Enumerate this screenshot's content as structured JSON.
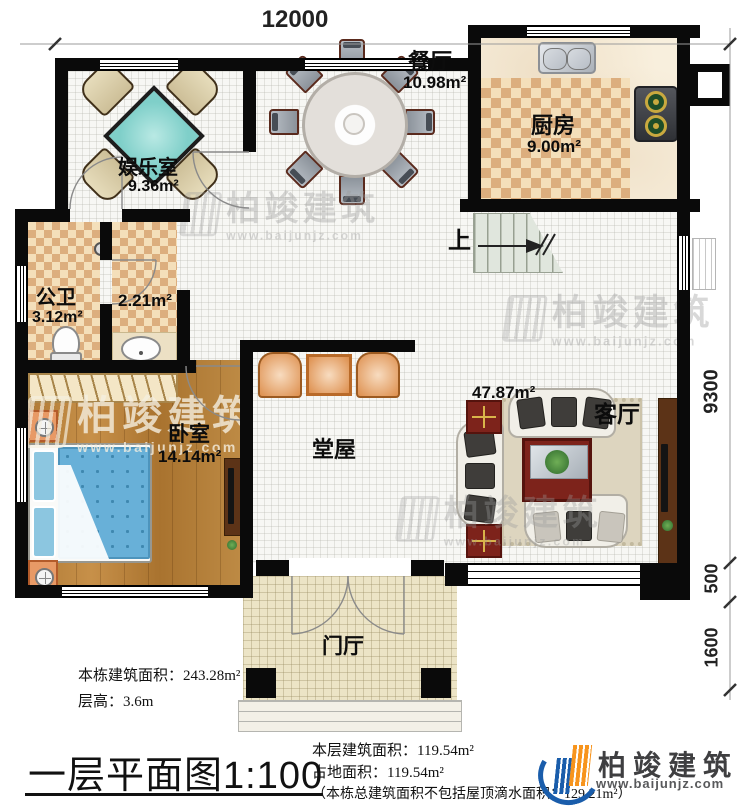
{
  "dimensions": {
    "top": "12000",
    "right_upper": "9300",
    "right_mid": "500",
    "right_lower": "1600"
  },
  "rooms": {
    "dining": {
      "name": "餐厅",
      "area": "10.98m²"
    },
    "kitchen": {
      "name": "厨房",
      "area": "9.00m²"
    },
    "entertainment": {
      "name": "娱乐室",
      "area": "9.36m²"
    },
    "bathroom": {
      "name": "公卫",
      "area": "3.12m²"
    },
    "washroom": {
      "area": "2.21m²"
    },
    "bedroom": {
      "name": "卧室",
      "area": "14.14m²"
    },
    "hall": {
      "name": "堂屋"
    },
    "living": {
      "name": "客厅",
      "area": "47.87m²"
    },
    "foyer": {
      "name": "门厅"
    },
    "stairs": {
      "label": "上"
    }
  },
  "watermark": {
    "brand": "柏竣建筑",
    "url": "www.baijunjz.com"
  },
  "footer": {
    "building_area": "本栋建筑面积：243.28m²",
    "floor_height": "层高：3.6m",
    "title": "一层平面图",
    "scale": "1:100",
    "floor_area": "本层建筑面积：119.54m²",
    "land_area": "占地面积：119.54m²",
    "note": "（本栋总建筑面积不包括屋顶滴水面积：129.21m²）",
    "brand": "柏竣建筑",
    "brand_url": "www.baijunjz.com"
  },
  "colors": {
    "brand_blue": "#1a5dab",
    "brand_orange": "#f7941d",
    "mahjong_teal": "#7fcfc9",
    "bed_blue": "#68b0d8",
    "wood_brown": "#b07b36",
    "checker_tan": "#dcaf80"
  }
}
